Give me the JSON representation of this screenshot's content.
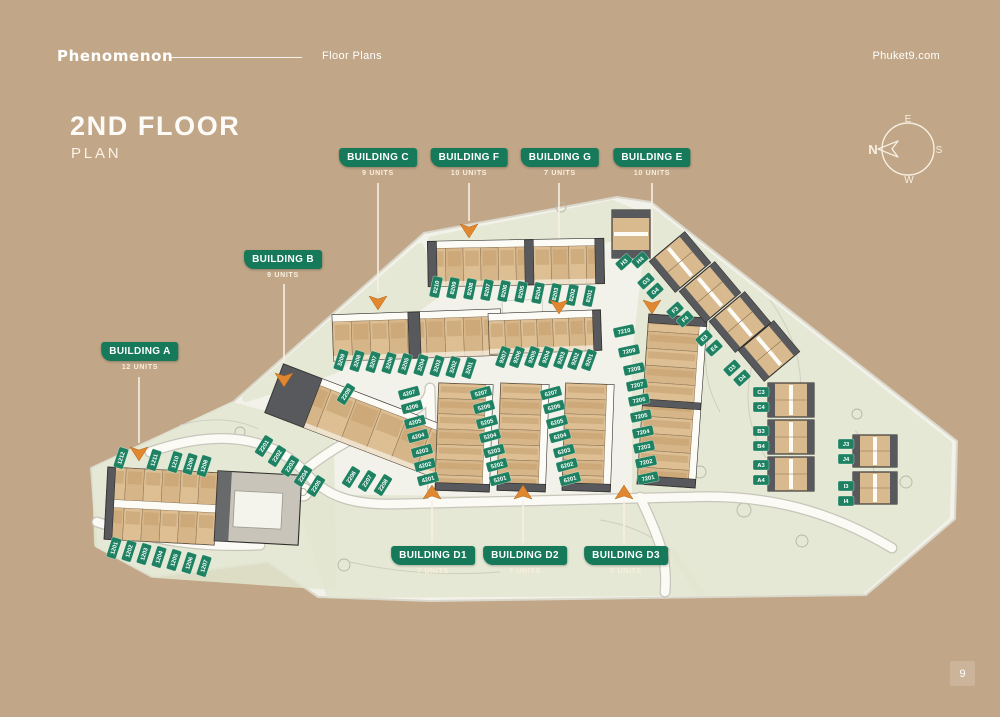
{
  "header": {
    "logo": "Phenomenon",
    "nav_label": "Floor Plans",
    "site_link": "Phuket9.com"
  },
  "title": {
    "main": "2ND FLOOR",
    "sub": "PLAN"
  },
  "compass": {
    "north": "N",
    "east": "E",
    "south": "S",
    "west": "W"
  },
  "page_number": "9",
  "colors": {
    "background": "#c1a687",
    "badge_green": "#15795a",
    "tag_green": "#1e8262",
    "arrow_orange": "#e0872f",
    "site_ground": "#f3f2ea",
    "landscape_green": "#e3e7d1",
    "building_tan": "#d9ba8e",
    "building_dark": "#57595c",
    "text_cream": "#f7f0e2"
  },
  "buildings": [
    {
      "id": "a",
      "label": "BUILDING A",
      "units_label": "12 UNITS",
      "unit_numbers": [
        "1201",
        "1202",
        "1203",
        "1204",
        "1205",
        "1206",
        "1207",
        "1208",
        "1209",
        "1210",
        "1211",
        "1212"
      ]
    },
    {
      "id": "b",
      "label": "BUILDING B",
      "units_label": "9 UNITS",
      "unit_numbers": [
        "2201",
        "2202",
        "2203",
        "2204",
        "2205",
        "2206",
        "2207",
        "2208",
        "2209"
      ]
    },
    {
      "id": "c",
      "label": "BUILDING C",
      "units_label": "9 UNITS",
      "unit_numbers": [
        "3201",
        "3202",
        "3203",
        "3204",
        "3205",
        "3206",
        "3207",
        "3208",
        "3209"
      ]
    },
    {
      "id": "d1",
      "label": "BUILDING D1",
      "units_label": "7 UNITS",
      "unit_numbers": [
        "4201",
        "4202",
        "4203",
        "4204",
        "4205",
        "4206",
        "4207"
      ]
    },
    {
      "id": "d2",
      "label": "BUILDING D2",
      "units_label": "7 UNITS",
      "unit_numbers": [
        "5201",
        "5202",
        "5203",
        "5204",
        "5205",
        "5206",
        "5207"
      ]
    },
    {
      "id": "d3",
      "label": "BUILDING D3",
      "units_label": "7 UNITS",
      "unit_numbers": [
        "6201",
        "6202",
        "6203",
        "6204",
        "6205",
        "6206",
        "6207"
      ]
    },
    {
      "id": "e",
      "label": "BUILDING E",
      "units_label": "10 UNITS",
      "unit_numbers": [
        "7201",
        "7202",
        "7203",
        "7204",
        "7205",
        "7206",
        "7207",
        "7208",
        "7209",
        "7210"
      ]
    },
    {
      "id": "f",
      "label": "BUILDING F",
      "units_label": "10 UNITS",
      "unit_numbers": [
        "8201",
        "8202",
        "8203",
        "8204",
        "8205",
        "8206",
        "8207",
        "8208",
        "8209",
        "8210"
      ]
    },
    {
      "id": "g",
      "label": "BUILDING G",
      "units_label": "7 UNITS",
      "unit_numbers": [
        "9201",
        "9202",
        "9203",
        "9204",
        "9205",
        "9206",
        "9207"
      ]
    }
  ],
  "chalet_tags": [
    "H3",
    "H4",
    "G3",
    "G4",
    "F3",
    "F4",
    "E3",
    "E4",
    "D3",
    "D4",
    "C3",
    "C4",
    "B3",
    "B4",
    "A3",
    "A4",
    "J3",
    "J4",
    "I3",
    "I4"
  ]
}
